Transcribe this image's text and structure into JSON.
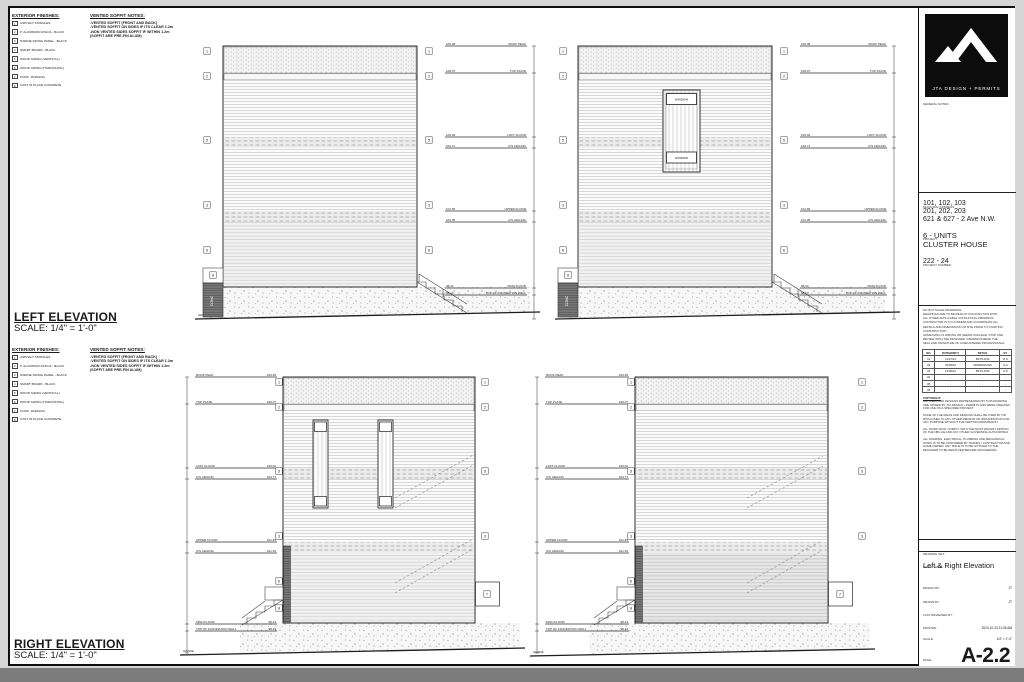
{
  "notes": {
    "exterior_finishes_title": "EXTERIOR FINISHES:",
    "finishes": [
      {
        "n": "1",
        "t": "ASPHALT SHINGLES"
      },
      {
        "n": "2",
        "t": "P. ALUMINUM FASCIA - BLACK"
      },
      {
        "n": "3",
        "t": "HARDIE SIDING PANEL - BLACK"
      },
      {
        "n": "4",
        "t": "SMART BOARD - BLACK"
      },
      {
        "n": "5",
        "t": "WOOD SIDING (VERTICAL)"
      },
      {
        "n": "6",
        "t": "WOOD SIDING (HORIZONTAL)"
      },
      {
        "n": "7",
        "t": "CONC. PARGING"
      },
      {
        "n": "8",
        "t": "CAST IN PLACE CONCRETE"
      }
    ],
    "soffit_title": "VENTED SOFFIT NOTES:",
    "soffit_lines": [
      "-VENTED SOFFIT (FRONT AND BACK)",
      "-VENTED SOFFIT ON SIDES IF ITS CLEAR 1.2m",
      "-NON VENTED SIDES SOFFIT IF WITHIN 1.2m",
      "(SOFFIT ARE PRE-FIN ALUM)"
    ]
  },
  "views": {
    "left": {
      "title": "LEFT ELEVATION",
      "scale": "SCALE: 1/4\" = 1'-0\""
    },
    "right": {
      "title": "RIGHT ELEVATION",
      "scale": "SCALE: 1/4\" = 1'-0\""
    }
  },
  "labels": {
    "grade": "GRADE",
    "conc": "CONC",
    "window": "WINDOW"
  },
  "callout_numbers": [
    "1",
    "2",
    "3",
    "4",
    "5",
    "6",
    "7",
    "8"
  ],
  "levels": [
    {
      "label": "ROOF PEAK",
      "elev": "109.48"
    },
    {
      "label": "TOP PLATE",
      "elev": "108.07"
    },
    {
      "label": "LOFT FLOOR",
      "elev": "105.02"
    },
    {
      "label": "U/S CEILING",
      "elev": "104.71"
    },
    {
      "label": "UPPER FLOOR",
      "elev": "101.65"
    },
    {
      "label": "U/S CEILING",
      "elev": "101.35"
    },
    {
      "label": "MAIN FLOOR",
      "elev": "98.43"
    },
    {
      "label": "TOP OF FOUNDATION WALL",
      "elev": "98.13"
    }
  ],
  "titleblock": {
    "logo": "JTA DESIGN + PERMITS",
    "general_notes_label": "GENERAL NOTES:",
    "municipal_label": "MUNICIPAL ADDRESS:",
    "address_lines": [
      "101, 102, 103",
      "201, 202, 203",
      "621 & 627 - 2 Ave N.W."
    ],
    "project_label": "PROJECT:",
    "project_lines": [
      "6 - UNITS",
      "CLUSTER HOUSE"
    ],
    "project_number_label": "PROJECT NUMBER:",
    "project_number": "222 - 24",
    "disclaimer_lines": [
      "DO NOT SCALE DRAWINGS.",
      "DRAWINGS ARE TO BE READ IN CONJUNCTION WITH",
      "ALL OTHER APPLICABLE CONSULTING DRAWINGS.",
      "CONTRACTOR IS TO CONFIRM AND COORDINATE ALL",
      "DETAILS AND DIMENSIONS ON SITE PRIOR TO STARTING",
      "CONSTRUCTION.",
      "SOMETHING IS WRONG OR SEEMS UNCLEAR, STOP AND",
      "REVIEW WITH THE DESIGNER. DRAWINGS BEAR THE",
      "SEAL AND SIGNATURE OF A REGISTERED PROFESSIONAL."
    ],
    "revisions": {
      "headers": [
        "NO.",
        "DATE(D/M/Y)",
        "DETAIL",
        "BY"
      ],
      "rows": [
        [
          "01",
          "11/07/24",
          "BP PLANS",
          "R.S"
        ],
        [
          "02",
          "04/09/24",
          "ADDRESSING",
          "A.G"
        ],
        [
          "03",
          "13/09/24",
          "BP PLANS",
          "A.S"
        ],
        [
          "04",
          "-",
          "-",
          "-"
        ],
        [
          "05",
          "-",
          "-",
          "-"
        ],
        [
          "06",
          "-",
          "-",
          "-"
        ]
      ]
    },
    "copyright_blocks": [
      {
        "h": "COPYRIGHT:",
        "b": "ALL IDEAS AND DESIGNS REPRESENTED BY THIS DRAWING ARE OWNED BY JTA DESIGN + PERMITS AND WERE CREATED FOR USE ON A SPECIFIED PROJECT."
      },
      {
        "h": "",
        "b": "NONE OF THE IDEAS AND DESIGNS SHALL BE USED BY OR DISCLOSED TO ANY OTHER PERSON OR ORGANIZATION FOR ANY PURPOSE WITHOUT THE WRITTEN PERMISSION."
      },
      {
        "h": "",
        "b": "ALL WORK MUST COMPLY WITH THE MOST RECENT EDITION OF THE NBC-AE AND ANY OTHER GOVERNING AUTHORITIES."
      },
      {
        "h": "",
        "b": "ALL FRAMING, ELECTRICAL, PLUMBING AND MECHANICAL WORK IS TO BE CONFIRMED BY TRADES / CONTRACTOR AND HOME OWNER. ANY ISSUE IS TO BE NOTICED TO THE DESIGNER TO BE RESOLVED BEFORE PROCEEDING."
      }
    ],
    "drawing_set_label": "DRAWING SET:",
    "sheet_name_label": "SHEET NAME:",
    "sheet_name": "Left & Right Elevation",
    "design_by_label": "DESIGN BY:",
    "design_by": "JT",
    "drawn_by_label": "DRAWN BY:",
    "drawn_by": "JT",
    "reviewed_label": "LAST REVIEWED BY:",
    "reviewed_by": "",
    "printed_label": "PRINTED:",
    "printed": "2024-10-23 11:06 AM",
    "scale_label": "SCALE:",
    "scale_value": "1/4\" = 1'-0\"",
    "page_label": "PAGE:",
    "page": "A-2.2"
  }
}
